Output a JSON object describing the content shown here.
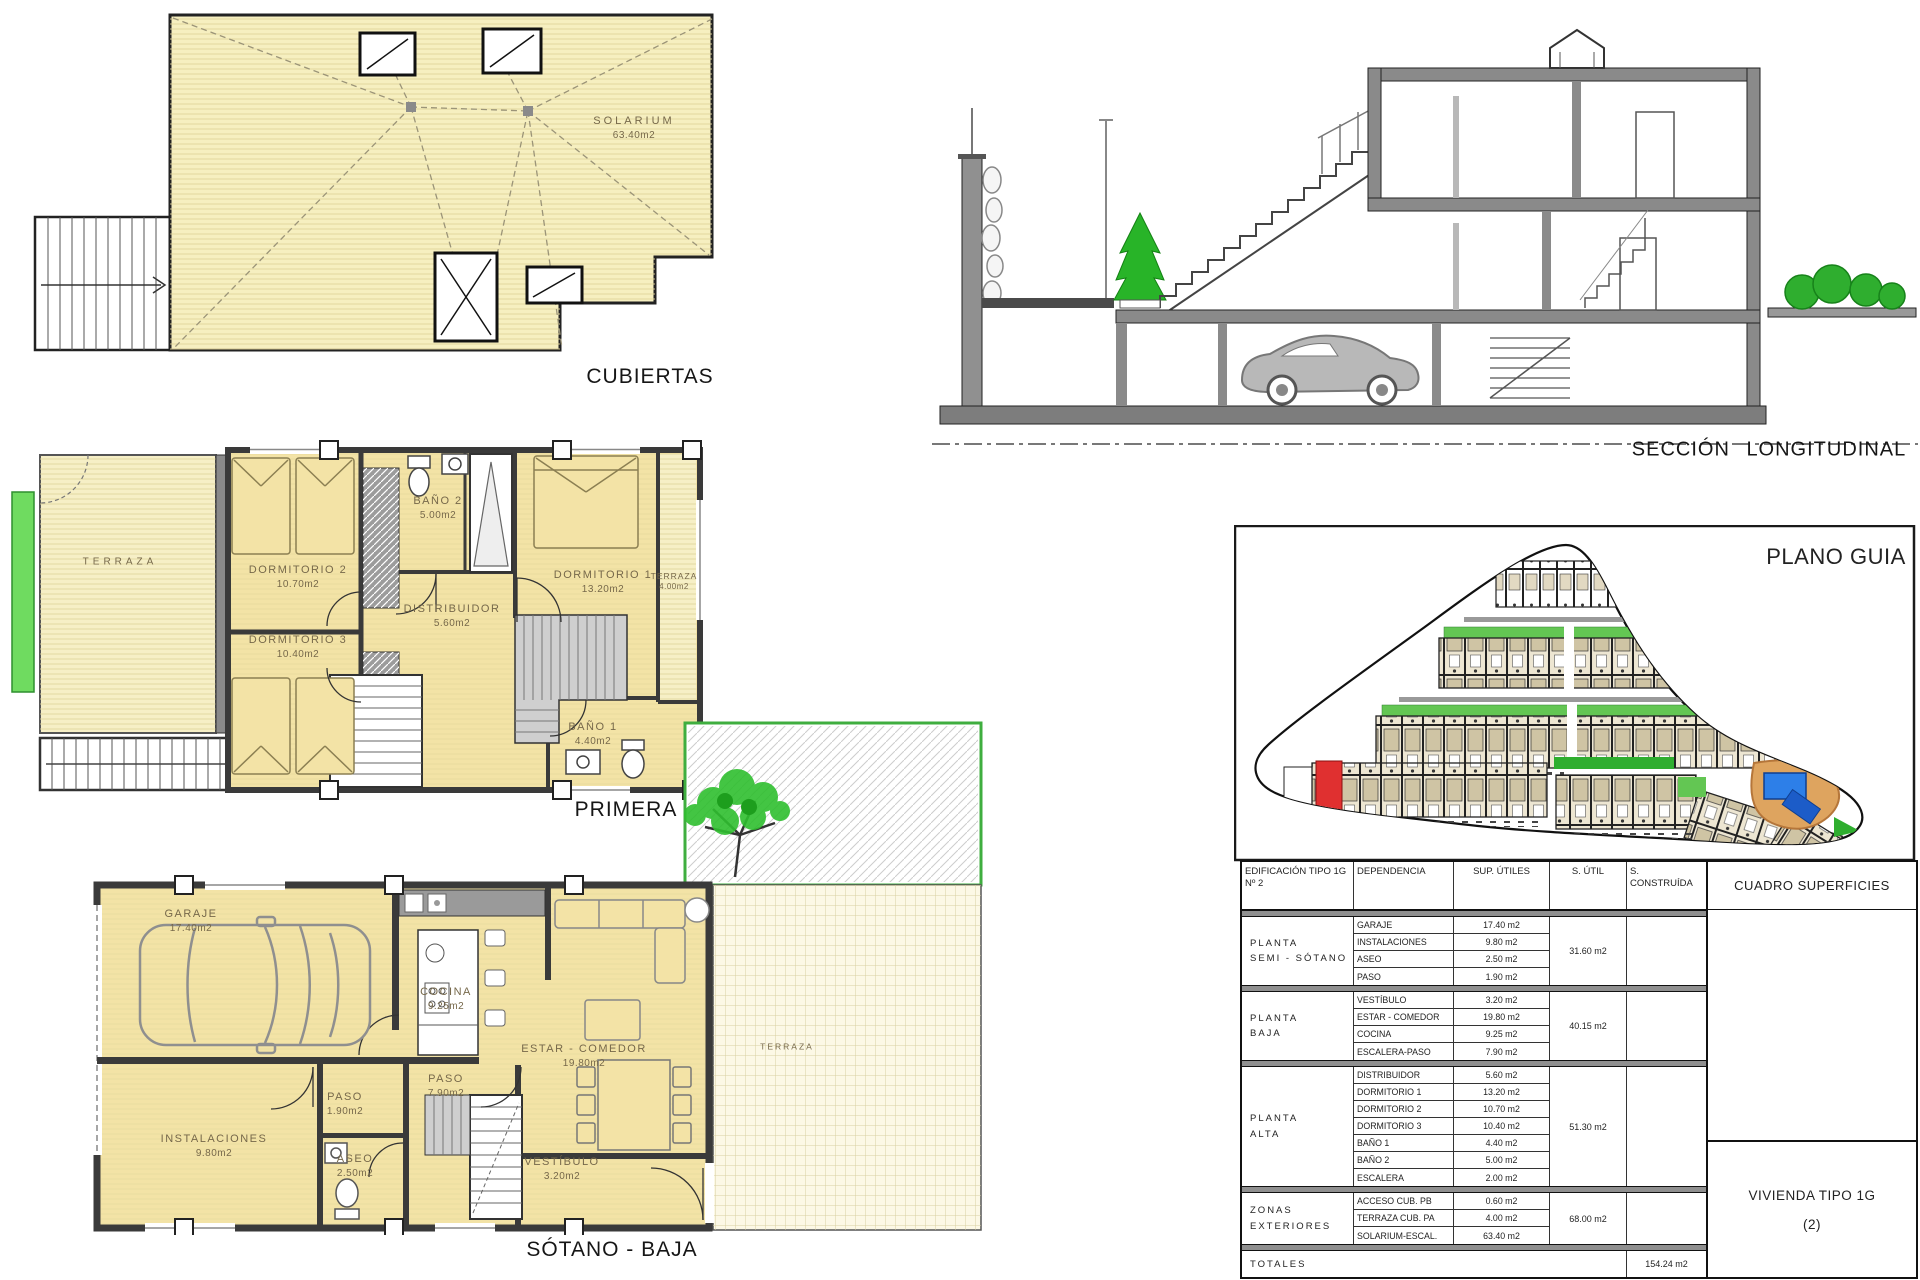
{
  "colors": {
    "plan_fill": "#F3E3A6",
    "terrace_fill": "#F6EFC6",
    "wall_gray": "#3a3a3a",
    "green_strip": "#6FDB60",
    "tree_green": "#2fbf2f",
    "red_unit": "#E03030",
    "pool_blue": "#2D7FE8",
    "pool_deck_orange": "#DEA45F"
  },
  "plans": {
    "cubiertas": {
      "title": "CUBIERTAS",
      "solarium": {
        "name": "SOLARIUM",
        "area": "63.40m2"
      }
    },
    "primera": {
      "title": "PRIMERA",
      "rooms": {
        "terraza_izq": {
          "name": "TERRAZA"
        },
        "dormitorio2": {
          "name": "DORMITORIO 2",
          "area": "10.70m2"
        },
        "dormitorio3": {
          "name": "DORMITORIO 3",
          "area": "10.40m2"
        },
        "bano2": {
          "name": "BAÑO 2",
          "area": "5.00m2"
        },
        "distribuidor": {
          "name": "DISTRIBUIDOR",
          "area": "5.60m2"
        },
        "dormitorio1": {
          "name": "DORMITORIO 1",
          "area": "13.20m2"
        },
        "terraza_der": {
          "name": "TERRAZA",
          "area": "4.00m2"
        },
        "bano1": {
          "name": "BAÑO 1",
          "area": "4.40m2"
        }
      }
    },
    "sotano": {
      "title": "SÓTANO - BAJA",
      "rooms": {
        "garaje": {
          "name": "GARAJE",
          "area": "17.40m2"
        },
        "cocina": {
          "name": "COCINA",
          "area": "9.25m2"
        },
        "estar": {
          "name": "ESTAR - COMEDOR",
          "area": "19.80m2"
        },
        "paso_pb": {
          "name": "PASO",
          "area": "7.90m2"
        },
        "paso_ss": {
          "name": "PASO",
          "area": "1.90m2"
        },
        "instalaciones": {
          "name": "INSTALACIONES",
          "area": "9.80m2"
        },
        "aseo": {
          "name": "ASEO",
          "area": "2.50m2"
        },
        "vestibulo": {
          "name": "VESTÍBULO",
          "area": "3.20m2"
        },
        "terraza": {
          "name": "TERRAZA"
        }
      }
    },
    "seccion": {
      "title": "SECCIÓN LONGITUDINAL"
    },
    "plano_guia": {
      "title": "PLANO GUIA"
    }
  },
  "surfaces_table": {
    "title": "CUADRO SUPERFICIES",
    "col_headers": {
      "edificacion": "EDIFICACIÓN TIPO 1G\nNº 2",
      "dependencia": "DEPENDENCIA",
      "sup_utiles": "SUP. ÚTILES",
      "s_util": "S. ÚTIL",
      "s_construida": "S. CONSTRUÍDA"
    },
    "groups": [
      {
        "label": "PLANTA\nSEMI - SÓTANO",
        "rows": [
          [
            "GARAJE",
            "17.40 m2"
          ],
          [
            "INSTALACIONES",
            "9.80 m2"
          ],
          [
            "ASEO",
            "2.50 m2"
          ],
          [
            "PASO",
            "1.90 m2"
          ]
        ],
        "s_util": "31.60 m2"
      },
      {
        "label": "PLANTA\nBAJA",
        "rows": [
          [
            "VESTÍBULO",
            "3.20 m2"
          ],
          [
            "ESTAR - COMEDOR",
            "19.80 m2"
          ],
          [
            "COCINA",
            "9.25 m2"
          ],
          [
            "ESCALERA-PASO",
            "7.90 m2"
          ]
        ],
        "s_util": "40.15 m2"
      },
      {
        "label": "PLANTA\nALTA",
        "rows": [
          [
            "DISTRIBUIDOR",
            "5.60 m2"
          ],
          [
            "DORMITORIO 1",
            "13.20 m2"
          ],
          [
            "DORMITORIO 2",
            "10.70 m2"
          ],
          [
            "DORMITORIO 3",
            "10.40 m2"
          ],
          [
            "BAÑO 1",
            "4.40 m2"
          ],
          [
            "BAÑO 2",
            "5.00 m2"
          ],
          [
            "ESCALERA",
            "2.00 m2"
          ]
        ],
        "s_util": "51.30 m2"
      },
      {
        "label": "ZONAS\nEXTERIORES",
        "rows": [
          [
            "ACCESO CUB. PB",
            "0.60 m2"
          ],
          [
            "TERRAZA CUB. PA",
            "4.00 m2"
          ],
          [
            "SOLARIUM-ESCAL.",
            "63.40 m2"
          ]
        ],
        "s_util": "68.00 m2"
      }
    ],
    "totals": {
      "label": "TOTALES",
      "s_construida": "154.24 m2"
    },
    "dwelling": {
      "line1": "VIVIENDA TIPO 1G",
      "line2": "(2)"
    }
  }
}
